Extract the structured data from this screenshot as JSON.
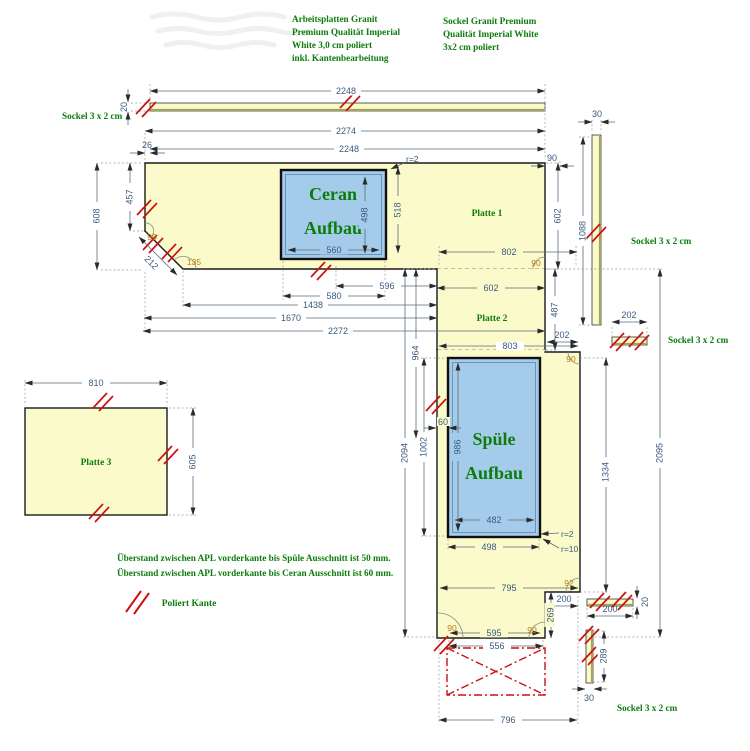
{
  "colors": {
    "plate_fill": "#FAFACA",
    "cutout_fill": "#A5CBEA",
    "hatch_red": "#CC1111",
    "note_green": "#0C7C0C",
    "dim_blue": "#3A5A80",
    "angle_orange": "#C07818"
  },
  "notes": {
    "material_note": [
      "Arbeitsplatten Granit",
      "Premium Qualität Imperial",
      "White 3,0 cm poliert",
      "inkl. Kantenbearbeitung"
    ],
    "sockel_note": [
      "Sockel Granit Premium",
      "Qualität Imperial White",
      "3x2 cm poliert"
    ],
    "overhang_note_1": "Überstand zwischen APL vorderkante bis Spüle Ausschnitt ist 50 mm.",
    "overhang_note_2": "Überstand zwischen APL vorderkante bis Ceran Ausschnitt ist 60 mm.",
    "legend_polished_edge": "Poliert Kante"
  },
  "labels": {
    "sockel": "Sockel 3 x 2 cm",
    "platte1": "Platte 1",
    "platte2": "Platte 2",
    "platte3": "Platte 3",
    "ceran_line1": "Ceran",
    "ceran_line2": "Aufbau",
    "spuele_line1": "Spüle",
    "spuele_line2": "Aufbau"
  },
  "dims": {
    "sockel_top_length": "2248",
    "sockel_top_height": "20",
    "plate1_total_width": "2274",
    "plate1_width": "2248",
    "plate1_left_offset": "26",
    "plate1_left_depth": "608",
    "plate1_left_front": "457",
    "chamfer_length": "212",
    "chamfer_angle_top": "90",
    "chamfer_angle": "135",
    "ceran_width_inner": "560",
    "ceran_height_inner": "498",
    "ceran_front_distance": "518",
    "ceran_radius": "r=2",
    "plate1_right_gap": "90",
    "plate1_right_depth": "602",
    "sockel_right_width": "30",
    "sockel_right_length": "1088",
    "gap_596": "596",
    "ceran_width_outer": "580",
    "dist_1438": "1438",
    "dist_1670": "1670",
    "plate1_bottom_width": "2272",
    "plate2_width": "602",
    "lower_top_width": "802",
    "plate2_corner_angle": "90",
    "plate2_depth": "487",
    "step_width": "202",
    "sockel_mid_length": "202",
    "lower_width_803": "803",
    "dist_964": "964",
    "sink_cutout_height_outer": "1002",
    "lower_total_2094": "2094",
    "sink_edge_gap": "60",
    "sink_height_inner": "986",
    "sink_width_inner": "482",
    "sink_width_outer": "498",
    "sink_radius_corner": "r=2",
    "sink_radius_edge": "r=10",
    "lower_right_1334": "1334",
    "lower_total_2095": "2095",
    "bottom_795": "795",
    "notch_angle": "92",
    "notch_width": "200",
    "notch_depth": "269",
    "bottom_mid_angle": "90",
    "bottom_left_angle": "90",
    "bottom_595": "595",
    "bottom_556": "556",
    "bottom_796": "796",
    "sockel_bottom_length": "200",
    "sockel_bottom_height": "20",
    "sockel_bv_length": "289",
    "sockel_bv_width": "30",
    "plate3_width": "810",
    "plate3_depth": "605"
  }
}
